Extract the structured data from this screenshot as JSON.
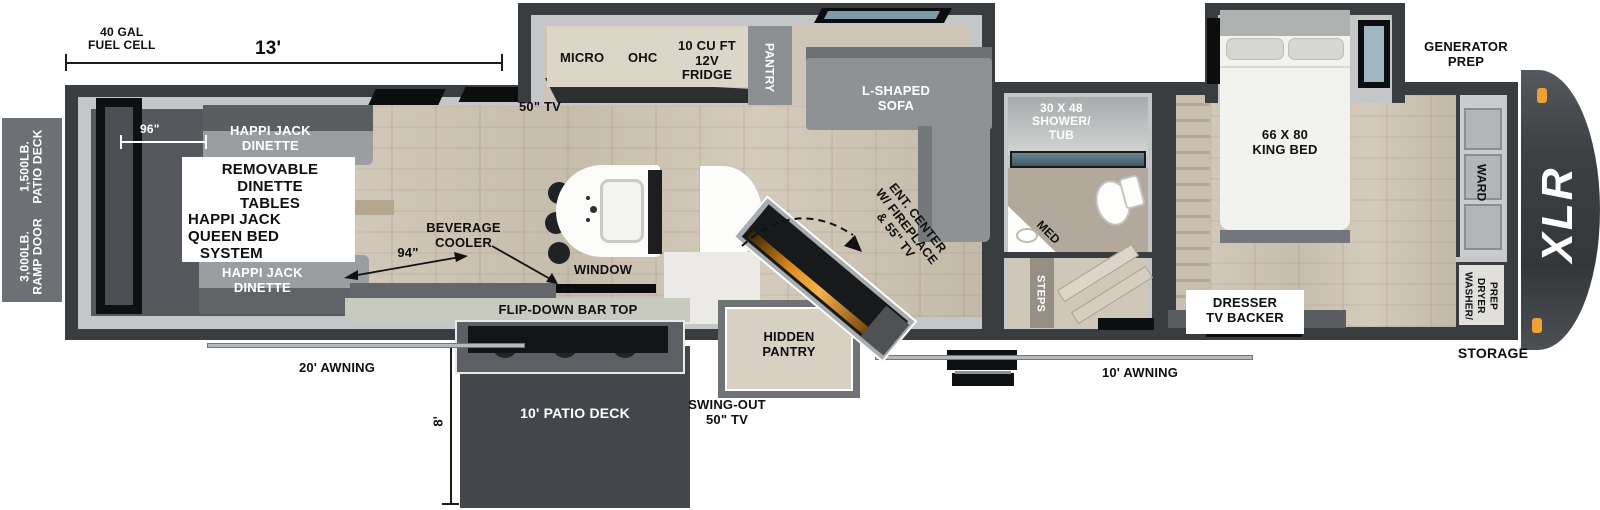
{
  "brand": "XLR",
  "colors": {
    "wall": "#3a3d40",
    "wall_light": "#c5c6c7",
    "wood_floor": "#cdc2b2",
    "garage_floor": "#55585c",
    "sofa_gray": "#8f9295",
    "counter_cream": "#dbd6c8",
    "deck_dark": "#43474b",
    "glass_teal": "#4a6570",
    "accent_orange": "#f0a133",
    "fire_glow": "#e08b1f"
  },
  "exterior": {
    "fuel_cell": [
      "40 GAL",
      "FUEL CELL"
    ],
    "dim_13ft": "13'",
    "patio_capacity": [
      "1,500LB.",
      "PATIO DECK"
    ],
    "ramp_capacity": [
      "3,000LB.",
      "RAMP DOOR"
    ],
    "awning_front": "20' AWNING",
    "awning_rear": "10' AWNING",
    "patio_deck": "10' PATIO DECK",
    "deck_width": "8'",
    "swing_tv": [
      "SWING-OUT",
      "50\" TV"
    ],
    "generator": [
      "GENERATOR",
      "PREP"
    ],
    "storage": "STORAGE"
  },
  "garage": {
    "dim_96": "96\"",
    "dim_94": "94\"",
    "dinette_top": [
      "HAPPI JACK",
      "DINETTE"
    ],
    "dinette_bottom": [
      "HAPPI JACK",
      "DINETTE"
    ],
    "info_box": [
      "REMOVABLE",
      "DINETTE",
      "TABLES"
    ],
    "queen_system": [
      "HAPPI JACK",
      "QUEEN BED",
      "SYSTEM"
    ],
    "tv": "50\" TV",
    "beverage": [
      "BEVERAGE",
      "COOLER"
    ],
    "flip_bar": "FLIP-DOWN BAR TOP"
  },
  "kitchen": {
    "micro": "MICRO",
    "ohc": "OHC",
    "fridge": [
      "10 CU FT",
      "12V",
      "FRIDGE"
    ],
    "pantry": "PANTRY",
    "window": "WINDOW",
    "hidden_pantry": [
      "HIDDEN",
      "PANTRY"
    ]
  },
  "living": {
    "sofa": [
      "L-SHAPED",
      "SOFA"
    ],
    "ent_center": [
      "ENT. CENTER",
      "W/ FIREPLACE",
      "& 55\" TV"
    ]
  },
  "bath": {
    "shower": [
      "30 X 48",
      "SHOWER/",
      "TUB"
    ],
    "med": "MED",
    "steps": "STEPS"
  },
  "bedroom": {
    "bed": [
      "66 X 80",
      "KING BED"
    ],
    "dresser": [
      "DRESSER",
      "TV BACKER"
    ],
    "ward": "WARD",
    "washer": [
      "WASHER/",
      "DRYER",
      "PREP"
    ]
  }
}
